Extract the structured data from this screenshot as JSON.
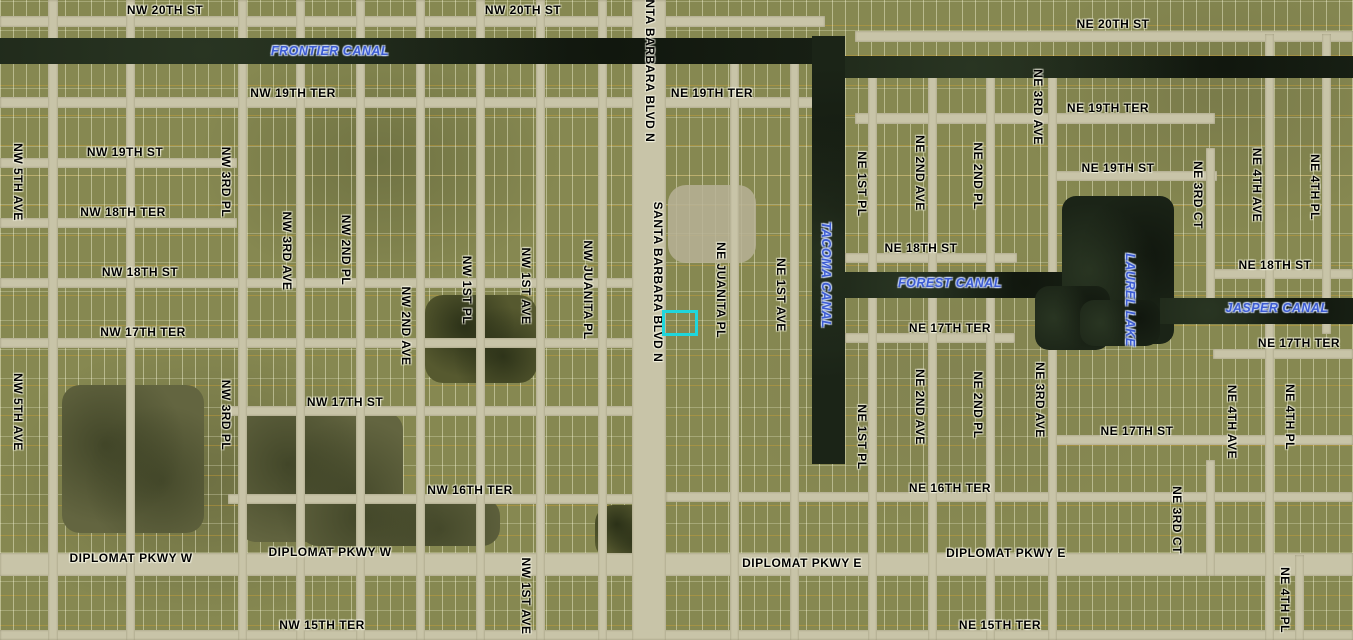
{
  "map": {
    "description": "Aerial parcel map with labeled streets and canals",
    "colors": {
      "land": "#868851",
      "road": "#c8c4a8",
      "water": "#1b2417",
      "street_label": "#000000",
      "water_label": "#3d5cd2",
      "highlight": "#1fd6dc",
      "lot_line_orange": "#d8a230",
      "parcel_line": "#fffde1"
    },
    "highlight": {
      "x": 662,
      "y": 310,
      "w": 30,
      "h": 20,
      "border": 3
    },
    "labels": [
      {
        "text": "NW 20TH ST",
        "x": 165,
        "y": 10,
        "dir": "h",
        "kind": "street"
      },
      {
        "text": "NW 20TH ST",
        "x": 523,
        "y": 10,
        "dir": "h",
        "kind": "street"
      },
      {
        "text": "NE 20TH ST",
        "x": 1113,
        "y": 24,
        "dir": "h",
        "kind": "street"
      },
      {
        "text": "FRONTIER CANAL",
        "x": 330,
        "y": 51,
        "dir": "h",
        "kind": "water"
      },
      {
        "text": "NW 19TH TER",
        "x": 293,
        "y": 93,
        "dir": "h",
        "kind": "street"
      },
      {
        "text": "NE 19TH TER",
        "x": 712,
        "y": 93,
        "dir": "h",
        "kind": "street"
      },
      {
        "text": "NE 19TH TER",
        "x": 1108,
        "y": 108,
        "dir": "h",
        "kind": "street"
      },
      {
        "text": "NW 19TH ST",
        "x": 125,
        "y": 152,
        "dir": "h",
        "kind": "street"
      },
      {
        "text": "NE 19TH ST",
        "x": 1118,
        "y": 168,
        "dir": "h",
        "kind": "street"
      },
      {
        "text": "NW 18TH TER",
        "x": 123,
        "y": 212,
        "dir": "h",
        "kind": "street"
      },
      {
        "text": "NE 18TH ST",
        "x": 921,
        "y": 248,
        "dir": "h",
        "kind": "street"
      },
      {
        "text": "NE 18TH ST",
        "x": 1275,
        "y": 265,
        "dir": "h",
        "kind": "street"
      },
      {
        "text": "NW 18TH ST",
        "x": 140,
        "y": 272,
        "dir": "h",
        "kind": "street"
      },
      {
        "text": "FOREST CANAL",
        "x": 950,
        "y": 283,
        "dir": "h",
        "kind": "water"
      },
      {
        "text": "JASPER CANAL",
        "x": 1277,
        "y": 308,
        "dir": "h",
        "kind": "water"
      },
      {
        "text": "NE 17TH TER",
        "x": 950,
        "y": 328,
        "dir": "h",
        "kind": "street"
      },
      {
        "text": "NW 17TH TER",
        "x": 143,
        "y": 332,
        "dir": "h",
        "kind": "street"
      },
      {
        "text": "NE 17TH TER",
        "x": 1299,
        "y": 343,
        "dir": "h",
        "kind": "street"
      },
      {
        "text": "NW 17TH ST",
        "x": 345,
        "y": 402,
        "dir": "h",
        "kind": "street"
      },
      {
        "text": "NE 17TH ST",
        "x": 1137,
        "y": 431,
        "dir": "h",
        "kind": "street"
      },
      {
        "text": "NW 16TH TER",
        "x": 470,
        "y": 490,
        "dir": "h",
        "kind": "street"
      },
      {
        "text": "NE 16TH TER",
        "x": 950,
        "y": 488,
        "dir": "h",
        "kind": "street"
      },
      {
        "text": "DIPLOMAT PKWY W",
        "x": 131,
        "y": 558,
        "dir": "h",
        "kind": "street"
      },
      {
        "text": "DIPLOMAT PKWY W",
        "x": 330,
        "y": 552,
        "dir": "h",
        "kind": "street"
      },
      {
        "text": "DIPLOMAT PKWY E",
        "x": 802,
        "y": 563,
        "dir": "h",
        "kind": "street"
      },
      {
        "text": "DIPLOMAT PKWY E",
        "x": 1006,
        "y": 553,
        "dir": "h",
        "kind": "street"
      },
      {
        "text": "NW 15TH TER",
        "x": 322,
        "y": 625,
        "dir": "h",
        "kind": "street"
      },
      {
        "text": "NE 15TH TER",
        "x": 1000,
        "y": 625,
        "dir": "h",
        "kind": "street"
      },
      {
        "text": "NW 5TH AVE",
        "x": 18,
        "y": 182,
        "dir": "v",
        "kind": "street"
      },
      {
        "text": "NW 5TH AVE",
        "x": 18,
        "y": 412,
        "dir": "v",
        "kind": "street"
      },
      {
        "text": "NW 3RD PL",
        "x": 226,
        "y": 182,
        "dir": "v",
        "kind": "street"
      },
      {
        "text": "NW 3RD PL",
        "x": 226,
        "y": 415,
        "dir": "v",
        "kind": "street"
      },
      {
        "text": "NW 3RD AVE",
        "x": 287,
        "y": 251,
        "dir": "v",
        "kind": "street"
      },
      {
        "text": "NW 2ND PL",
        "x": 346,
        "y": 250,
        "dir": "v",
        "kind": "street"
      },
      {
        "text": "NW 2ND AVE",
        "x": 406,
        "y": 326,
        "dir": "v",
        "kind": "street"
      },
      {
        "text": "NW 1ST PL",
        "x": 467,
        "y": 290,
        "dir": "v",
        "kind": "street"
      },
      {
        "text": "NW 1ST AVE",
        "x": 526,
        "y": 286,
        "dir": "v",
        "kind": "street"
      },
      {
        "text": "NW JUANITA PL",
        "x": 588,
        "y": 290,
        "dir": "v",
        "kind": "street"
      },
      {
        "text": "SANTA BARBARA BLVD N",
        "x": 650,
        "y": 62,
        "dir": "v",
        "kind": "street"
      },
      {
        "text": "SANTA BARBARA BLVD N",
        "x": 658,
        "y": 282,
        "dir": "v",
        "kind": "street"
      },
      {
        "text": "NE JUANITA PL",
        "x": 721,
        "y": 290,
        "dir": "v",
        "kind": "street"
      },
      {
        "text": "NE 1ST AVE",
        "x": 781,
        "y": 295,
        "dir": "v",
        "kind": "street"
      },
      {
        "text": "TACOMA CANAL",
        "x": 826,
        "y": 275,
        "dir": "v",
        "kind": "water"
      },
      {
        "text": "NE 1ST PL",
        "x": 862,
        "y": 184,
        "dir": "v",
        "kind": "street"
      },
      {
        "text": "NE 2ND AVE",
        "x": 920,
        "y": 173,
        "dir": "v",
        "kind": "street"
      },
      {
        "text": "NE 2ND PL",
        "x": 978,
        "y": 176,
        "dir": "v",
        "kind": "street"
      },
      {
        "text": "NE 3RD AVE",
        "x": 1038,
        "y": 107,
        "dir": "v",
        "kind": "street"
      },
      {
        "text": "LAUREL LAKE",
        "x": 1130,
        "y": 300,
        "dir": "v",
        "kind": "water"
      },
      {
        "text": "NE 3RD CT",
        "x": 1198,
        "y": 195,
        "dir": "v",
        "kind": "street"
      },
      {
        "text": "NE 4TH AVE",
        "x": 1257,
        "y": 185,
        "dir": "v",
        "kind": "street"
      },
      {
        "text": "NE 4TH PL",
        "x": 1315,
        "y": 187,
        "dir": "v",
        "kind": "street"
      },
      {
        "text": "NE 3RD AVE",
        "x": 1040,
        "y": 400,
        "dir": "v",
        "kind": "street"
      },
      {
        "text": "NE 4TH AVE",
        "x": 1232,
        "y": 422,
        "dir": "v",
        "kind": "street"
      },
      {
        "text": "NE 4TH PL",
        "x": 1290,
        "y": 417,
        "dir": "v",
        "kind": "street"
      },
      {
        "text": "NE 1ST PL",
        "x": 862,
        "y": 437,
        "dir": "v",
        "kind": "street"
      },
      {
        "text": "NE 2ND AVE",
        "x": 920,
        "y": 407,
        "dir": "v",
        "kind": "street"
      },
      {
        "text": "NE 2ND PL",
        "x": 978,
        "y": 405,
        "dir": "v",
        "kind": "street"
      },
      {
        "text": "NE 3RD CT",
        "x": 1177,
        "y": 520,
        "dir": "v",
        "kind": "street"
      },
      {
        "text": "NE 4TH PL",
        "x": 1285,
        "y": 600,
        "dir": "v",
        "kind": "street"
      },
      {
        "text": "NW 1ST AVE",
        "x": 526,
        "y": 596,
        "dir": "v",
        "kind": "street"
      }
    ],
    "roads": [
      {
        "name": "nw-20th-st",
        "x": 0,
        "y": 16,
        "w": 825,
        "h": 11
      },
      {
        "name": "ne-20th-st",
        "x": 855,
        "y": 31,
        "w": 498,
        "h": 11
      },
      {
        "name": "nw-19th-ter",
        "x": 0,
        "y": 97,
        "w": 830,
        "h": 11
      },
      {
        "name": "ne-19th-ter-e",
        "x": 855,
        "y": 113,
        "w": 360,
        "h": 11
      },
      {
        "name": "nw-19th-st",
        "x": 0,
        "y": 158,
        "w": 237,
        "h": 10
      },
      {
        "name": "ne-19th-st",
        "x": 1055,
        "y": 171,
        "w": 162,
        "h": 10
      },
      {
        "name": "nw-18th-ter",
        "x": 0,
        "y": 218,
        "w": 237,
        "h": 10
      },
      {
        "name": "ne-18th-st-mid",
        "x": 845,
        "y": 253,
        "w": 172,
        "h": 10
      },
      {
        "name": "ne-18th-st-e",
        "x": 1210,
        "y": 269,
        "w": 143,
        "h": 10
      },
      {
        "name": "nw-18th-st",
        "x": 0,
        "y": 278,
        "w": 666,
        "h": 10
      },
      {
        "name": "ne-17th-ter-mid",
        "x": 845,
        "y": 333,
        "w": 170,
        "h": 10
      },
      {
        "name": "nw-17th-ter",
        "x": 0,
        "y": 338,
        "w": 666,
        "h": 10
      },
      {
        "name": "ne-17th-ter-e",
        "x": 1213,
        "y": 349,
        "w": 140,
        "h": 10
      },
      {
        "name": "nw-17th-st",
        "x": 228,
        "y": 406,
        "w": 438,
        "h": 10
      },
      {
        "name": "ne-17th-st",
        "x": 1048,
        "y": 435,
        "w": 305,
        "h": 10
      },
      {
        "name": "nw-16th-ter",
        "x": 228,
        "y": 494,
        "w": 438,
        "h": 10
      },
      {
        "name": "ne-16th-ter",
        "x": 666,
        "y": 492,
        "w": 687,
        "h": 10
      },
      {
        "name": "diplomat-pkwy",
        "x": 0,
        "y": 553,
        "w": 1353,
        "h": 23
      },
      {
        "name": "15th-ter",
        "x": 0,
        "y": 630,
        "w": 1353,
        "h": 10
      },
      {
        "name": "nw-5th-ave-rd",
        "x": 48,
        "y": 0,
        "w": 10,
        "h": 640
      },
      {
        "name": "nw-4th-rd",
        "x": 126,
        "y": 0,
        "w": 9,
        "h": 640
      },
      {
        "name": "nw-3rd-pl-rd",
        "x": 238,
        "y": 0,
        "w": 9,
        "h": 640
      },
      {
        "name": "nw-3rd-ave-rd",
        "x": 296,
        "y": 0,
        "w": 9,
        "h": 640
      },
      {
        "name": "nw-2nd-pl-rd",
        "x": 356,
        "y": 0,
        "w": 9,
        "h": 640
      },
      {
        "name": "nw-2nd-ave-rd",
        "x": 416,
        "y": 0,
        "w": 9,
        "h": 640
      },
      {
        "name": "nw-1st-pl-rd",
        "x": 476,
        "y": 0,
        "w": 9,
        "h": 640
      },
      {
        "name": "nw-1st-ave-rd",
        "x": 536,
        "y": 0,
        "w": 9,
        "h": 640
      },
      {
        "name": "nw-juanita-pl-rd",
        "x": 598,
        "y": 0,
        "w": 9,
        "h": 640
      },
      {
        "name": "santa-barbara-blvd",
        "x": 632,
        "y": 0,
        "w": 34,
        "h": 640
      },
      {
        "name": "ne-juanita-pl-rd",
        "x": 730,
        "y": 60,
        "w": 9,
        "h": 580
      },
      {
        "name": "ne-1st-ave-rd",
        "x": 790,
        "y": 60,
        "w": 9,
        "h": 580
      },
      {
        "name": "ne-1st-pl-rd",
        "x": 868,
        "y": 64,
        "w": 9,
        "h": 576
      },
      {
        "name": "ne-2nd-ave-rd",
        "x": 928,
        "y": 60,
        "w": 9,
        "h": 580
      },
      {
        "name": "ne-2nd-pl-rd",
        "x": 986,
        "y": 60,
        "w": 9,
        "h": 580
      },
      {
        "name": "ne-3rd-ave-rd",
        "x": 1048,
        "y": 56,
        "w": 9,
        "h": 584
      },
      {
        "name": "ne-3rd-ct-rd-n",
        "x": 1206,
        "y": 148,
        "w": 9,
        "h": 162
      },
      {
        "name": "ne-3rd-ct-rd-s",
        "x": 1206,
        "y": 460,
        "w": 9,
        "h": 116
      },
      {
        "name": "ne-4th-ave-rd",
        "x": 1265,
        "y": 34,
        "w": 9,
        "h": 606
      },
      {
        "name": "ne-4th-pl-rd-n",
        "x": 1322,
        "y": 34,
        "w": 9,
        "h": 300
      },
      {
        "name": "ne-4th-pl-rd-s",
        "x": 1295,
        "y": 555,
        "w": 9,
        "h": 85
      }
    ],
    "water": [
      {
        "name": "frontier-canal",
        "x": 0,
        "y": 38,
        "w": 812,
        "h": 26,
        "round": false
      },
      {
        "name": "ne-canal-top",
        "x": 845,
        "y": 56,
        "w": 508,
        "h": 22,
        "round": false
      },
      {
        "name": "tacoma-canal",
        "x": 812,
        "y": 36,
        "w": 33,
        "h": 428,
        "round": false
      },
      {
        "name": "forest-canal",
        "x": 845,
        "y": 272,
        "w": 240,
        "h": 26,
        "round": false
      },
      {
        "name": "laurel-lake-main",
        "x": 1062,
        "y": 196,
        "w": 112,
        "h": 148,
        "round": true
      },
      {
        "name": "laurel-lake-arm",
        "x": 1035,
        "y": 286,
        "w": 75,
        "h": 64,
        "round": true
      },
      {
        "name": "laurel-lake-south",
        "x": 1080,
        "y": 300,
        "w": 80,
        "h": 46,
        "round": true
      },
      {
        "name": "jasper-canal",
        "x": 1160,
        "y": 298,
        "w": 193,
        "h": 26,
        "round": false
      }
    ],
    "patches": [
      {
        "name": "vacant-field-sw",
        "x": 62,
        "y": 385,
        "w": 142,
        "h": 148,
        "kind": "dark"
      },
      {
        "name": "vacant-field-17th",
        "x": 238,
        "y": 412,
        "w": 165,
        "h": 130,
        "kind": "dark"
      },
      {
        "name": "vacant-field-16th",
        "x": 300,
        "y": 498,
        "w": 200,
        "h": 48,
        "kind": "dark"
      },
      {
        "name": "tree-patch-center",
        "x": 425,
        "y": 295,
        "w": 112,
        "h": 88,
        "kind": "trees"
      },
      {
        "name": "tree-patch-south",
        "x": 595,
        "y": 505,
        "w": 62,
        "h": 55,
        "kind": "trees"
      },
      {
        "name": "cleared-lot",
        "x": 668,
        "y": 185,
        "w": 88,
        "h": 78,
        "kind": "sand"
      }
    ]
  }
}
